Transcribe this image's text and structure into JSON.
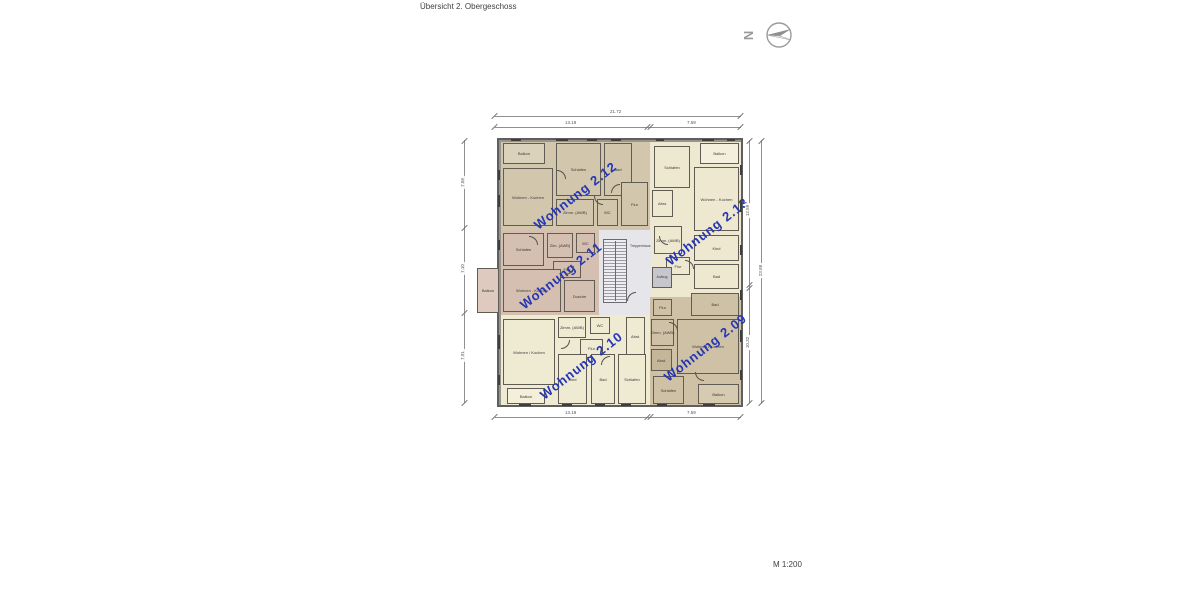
{
  "page": {
    "title": "Übersicht 2. Obergeschoss",
    "scale_label": "M 1:200",
    "north_label": "N"
  },
  "dimensions": {
    "top_total": "21.72",
    "top_left": "13.19",
    "top_right": "7.59",
    "bottom_left": "13.19",
    "bottom_right": "7.59",
    "left_top": "7.58",
    "left_middle": "7.10",
    "left_bottom": "7.91",
    "right_upper": "12.59",
    "right_lower": "10.32",
    "right_total": "23.88"
  },
  "core": {
    "stairwell_label": "Treppenhaus",
    "elevator_label": "Aufzug"
  },
  "apartments": [
    {
      "label": "Wohnung 2.12",
      "color": "#d2c7ad",
      "rooms": [
        "Balkon",
        "Wohnen - Kochen",
        "Schlafen",
        "Bad",
        "Zimm. (AWB)",
        "WC",
        "Flur"
      ]
    },
    {
      "label": "Wohnung 2.13",
      "color": "#efe8d1",
      "rooms": [
        "Schlafen",
        "Balkon",
        "Wohnen - Kochen",
        "Abst.",
        "Zimm. (AWB)",
        "Flur",
        "Kind",
        "Bad"
      ]
    },
    {
      "label": "Wohnung 2.11",
      "color": "#d5bfb1",
      "rooms": [
        "Balkon",
        "Schlafen",
        "Zim. (AWB)",
        "WC",
        "Flur",
        "Wohnen - Kochen",
        "Dusche"
      ]
    },
    {
      "label": "Wohnung 2.10",
      "color": "#efead2",
      "rooms": [
        "Wohnen / Kochen",
        "Balkon",
        "Zimm. (AWB)",
        "WC",
        "Flur",
        "Abst.",
        "Kind",
        "Bad",
        "Schlafen"
      ]
    },
    {
      "label": "Wohnung 2.09",
      "color": "#cec1a5",
      "rooms": [
        "Flur",
        "Bad",
        "Zimm. (AWB)",
        "Abst.",
        "Wohnen / Kochen",
        "Schlafen",
        "Balkon"
      ]
    }
  ]
}
